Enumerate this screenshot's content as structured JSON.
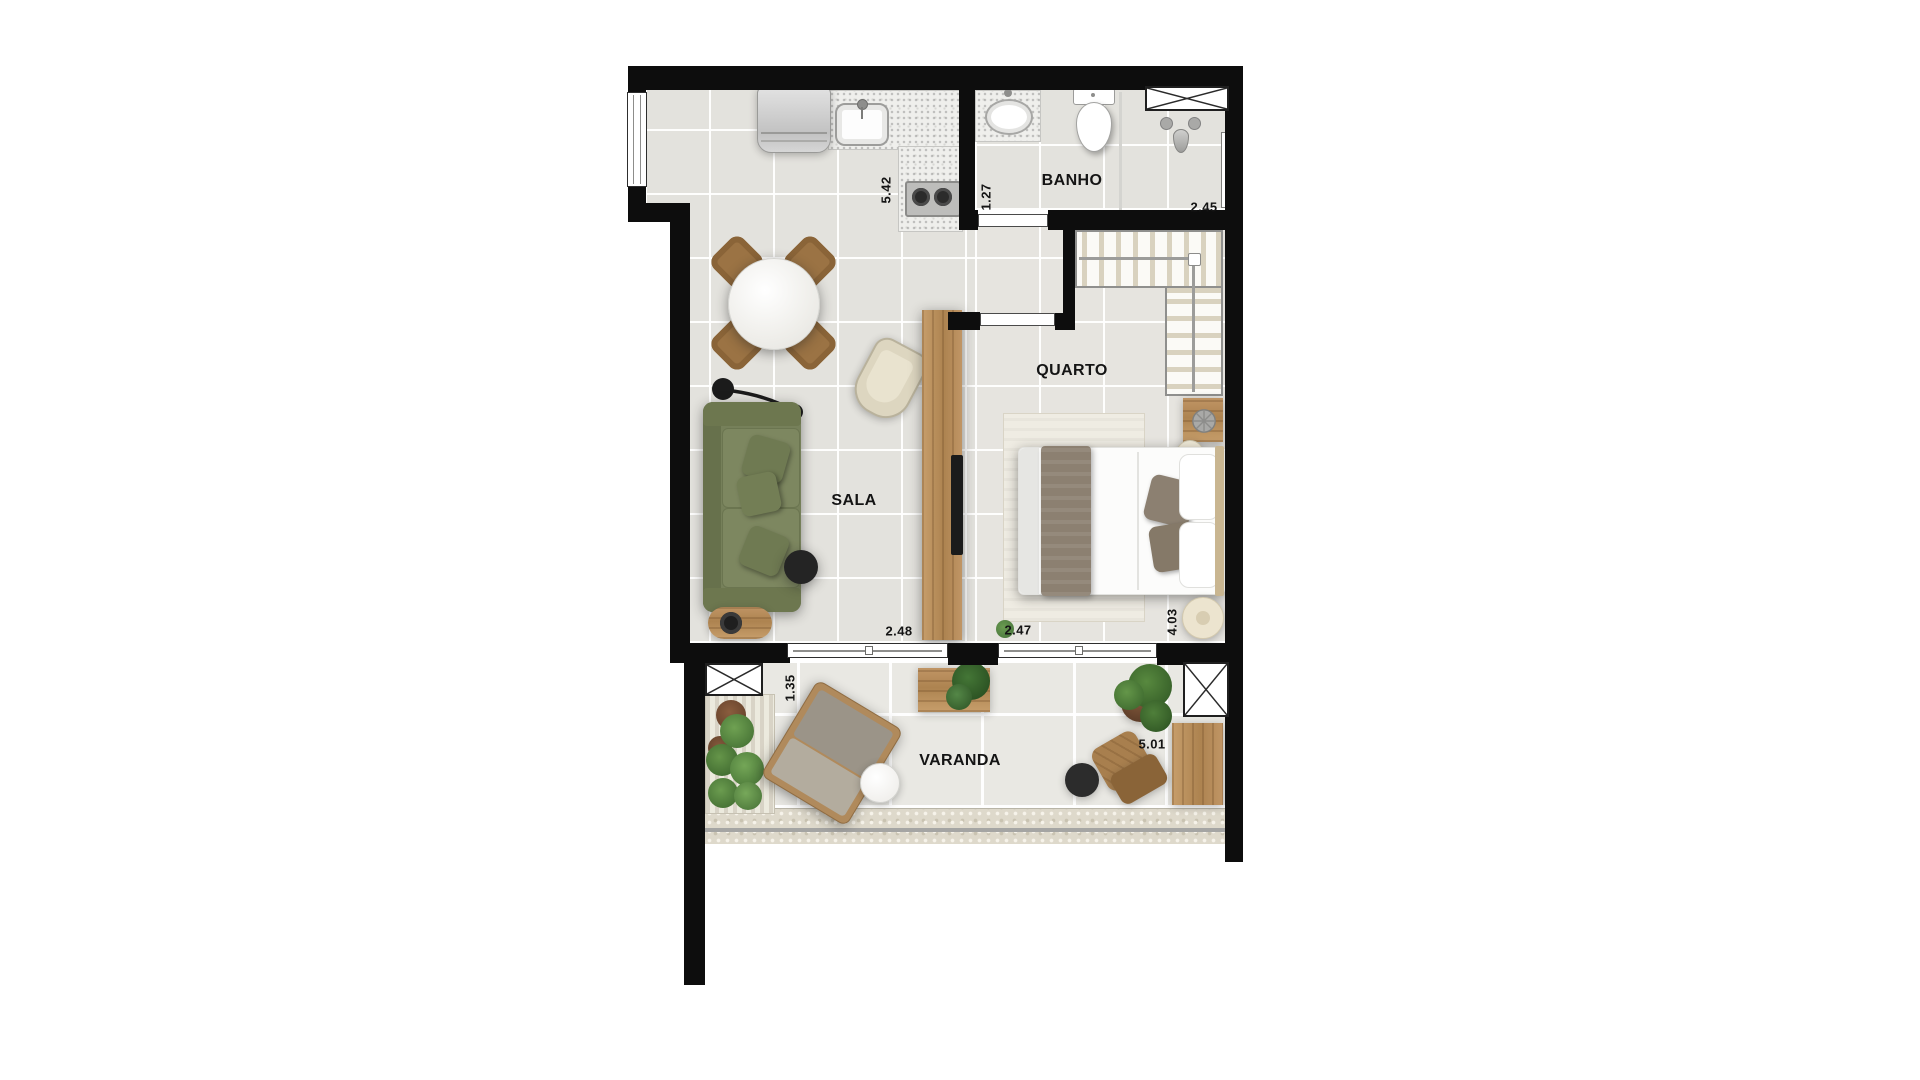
{
  "floorplan": {
    "rooms": {
      "banho": {
        "label": "BANHO"
      },
      "quarto": {
        "label": "QUARTO"
      },
      "sala": {
        "label": "SALA"
      },
      "varanda": {
        "label": "VARANDA"
      }
    },
    "dimensions": {
      "kitchen_length": "5.42",
      "bath_width": "1.27",
      "bath_length": "2.45",
      "sala_width": "2.48",
      "quarto_width": "2.47",
      "quarto_length": "4.03",
      "varanda_width": "1.35",
      "varanda_length": "5.01"
    },
    "colors": {
      "wall": "#0d0d0d",
      "floor_tile": "#e3e2dd",
      "balcony_tile": "#e9e8e3",
      "wood": "#b98e5c",
      "sofa_green": "#76805a",
      "plant_green": "#4f7a38",
      "label_text": "#141414",
      "background": "#ffffff"
    }
  }
}
